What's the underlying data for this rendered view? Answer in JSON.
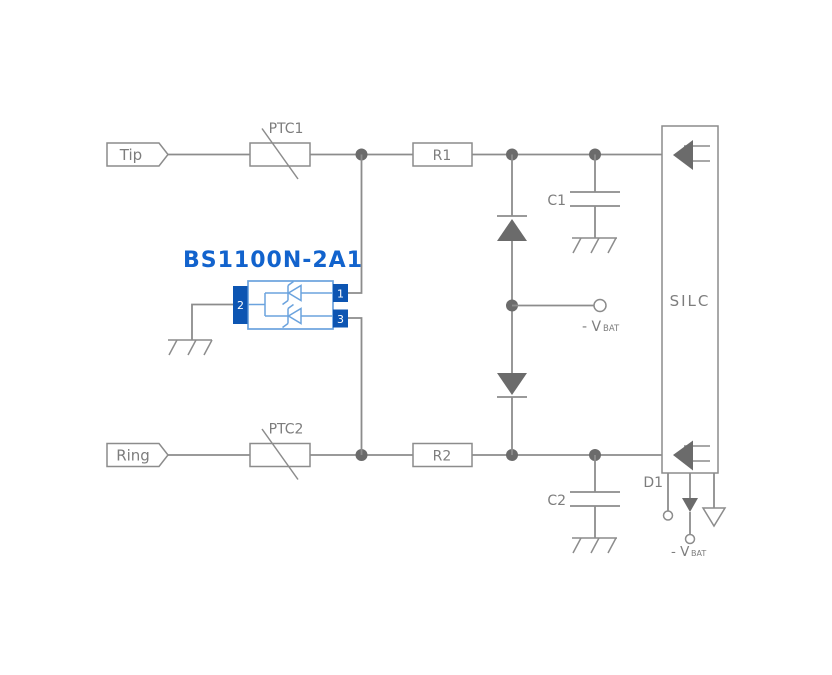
{
  "colors": {
    "background": "#ffffff",
    "wire": "#8c8c8c",
    "fill_dark": "#6b6b6b",
    "label_text": "#7d7d7d",
    "title_blue": "#1263cd",
    "pin_fill": "#0d55b2",
    "symbol_blue": "#6ba3de"
  },
  "terminals": {
    "tip": "Tip",
    "ring": "Ring"
  },
  "components": {
    "ptc1": "PTC1",
    "ptc2": "PTC2",
    "r1": "R1",
    "r2": "R2",
    "c1": "C1",
    "c2": "C2",
    "d1": "D1",
    "silc": "SILC"
  },
  "protector": {
    "title": "BS1100N-2A1",
    "pins": {
      "p1": "1",
      "p2": "2",
      "p3": "3"
    }
  },
  "supply": {
    "vbat_mid": {
      "main": "- V",
      "sub": "BAT"
    },
    "vbat_bottom": {
      "main": "- V",
      "sub": "BAT"
    }
  }
}
